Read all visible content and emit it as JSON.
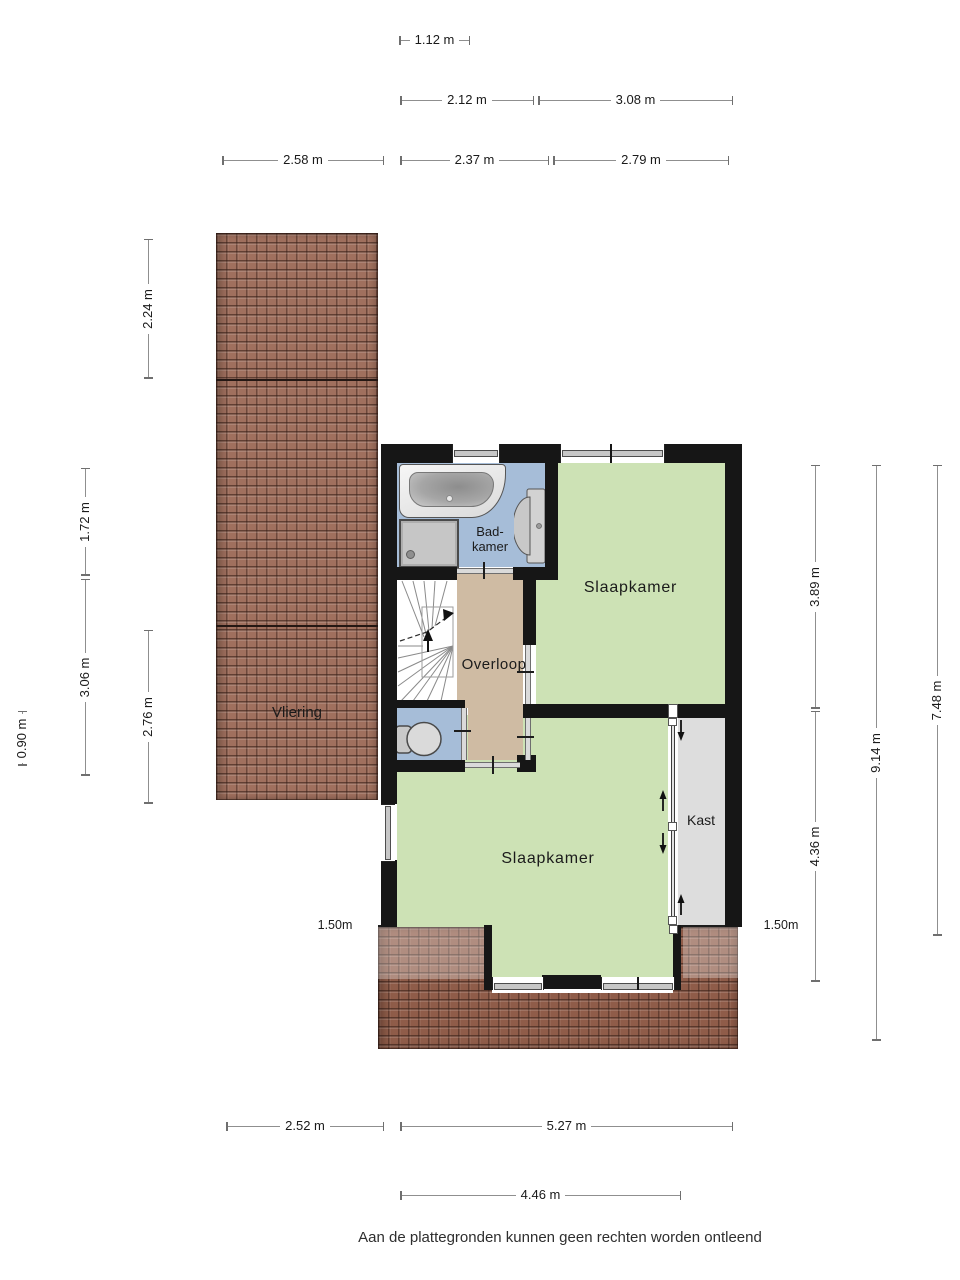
{
  "rooms": {
    "vliering": "Vliering",
    "badkamer_line1": "Bad-",
    "badkamer_line2": "kamer",
    "slaapkamer_boven": "Slaapkamer",
    "overloop": "Overloop",
    "slaapkamer_beneden": "Slaapkamer",
    "kast": "Kast"
  },
  "dimensions": {
    "top_row_1": [
      "1.12 m"
    ],
    "top_row_2": [
      "2.12 m",
      "3.08 m"
    ],
    "top_row_3": [
      "2.58 m",
      "2.37 m",
      "2.79 m"
    ],
    "left": [
      "2.24 m",
      "1.72 m",
      "3.06 m",
      "2.76 m",
      "0.90 m"
    ],
    "right": [
      "3.89 m",
      "4.36 m",
      "9.14 m",
      "7.48 m"
    ],
    "bottom_row_1": [
      "2.52 m",
      "5.27 m"
    ],
    "bottom_row_2": [
      "4.46 m"
    ],
    "inline": [
      "1.50m",
      "1.50m"
    ]
  },
  "footer": {
    "disclaimer": "Aan de plattegronden kunnen geen rechten worden ontleend"
  },
  "colors": {
    "wall": "#161616",
    "floor_bedroom": "#cde2b5",
    "floor_bathroom": "#a6bdd8",
    "floor_landing": "#cfbba3",
    "floor_closet": "#dddddd",
    "roof_tile": "#a0705e",
    "dim_line": "#8f8f8f",
    "text": "#1a1a1a"
  }
}
